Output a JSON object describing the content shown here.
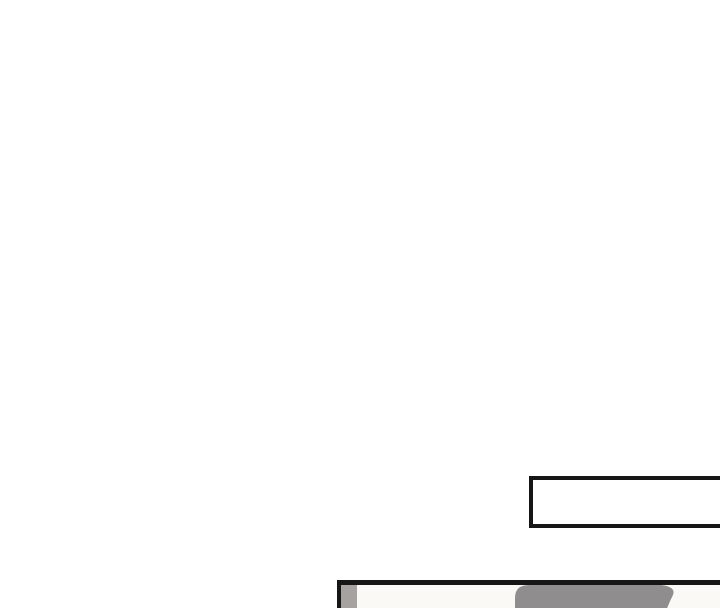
{
  "page": {
    "kind": "comic-page-fragment",
    "caption_box": {
      "text": ""
    }
  },
  "colors": {
    "page_bg": "#ffffff",
    "ink": "#161616",
    "panel_bg": "#fbf9f5",
    "shade_gray": "#a5a2a0",
    "figure_gray": "#8f8d8e"
  }
}
